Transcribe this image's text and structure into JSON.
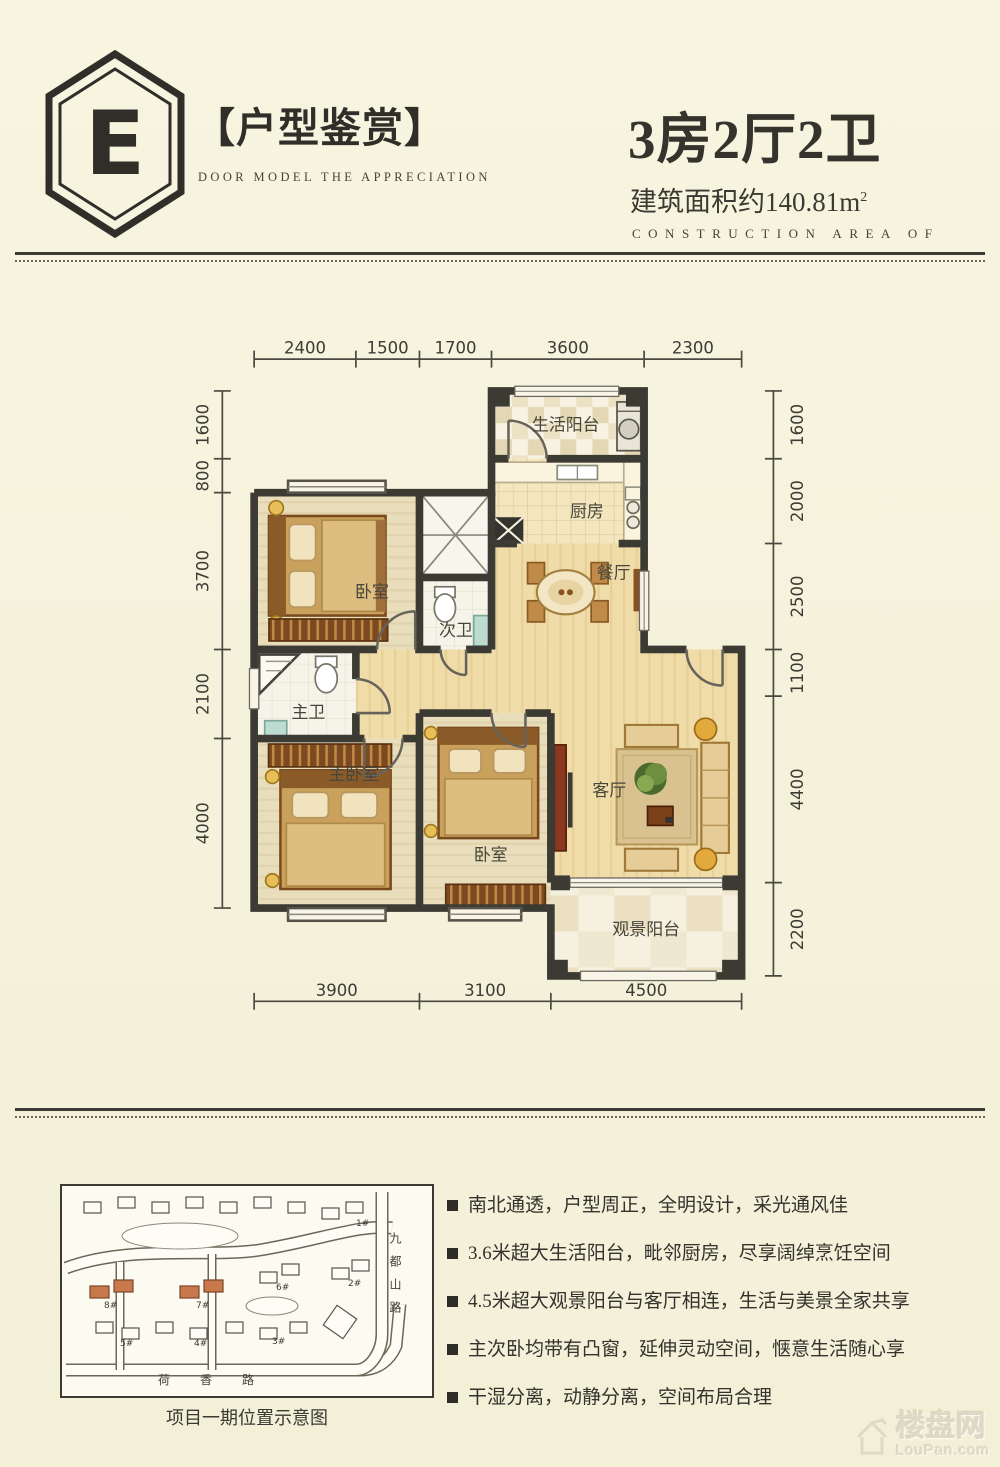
{
  "header": {
    "logo_letter": "E",
    "title": "【户型鉴赏】",
    "subtitle": "DOOR MODEL THE APPRECIATION",
    "unit_type": "3房2厅2卫",
    "area_label": "建筑面积约140.81m",
    "area_sup": "2",
    "area_en": "CONSTRUCTION AREA OF"
  },
  "plan": {
    "dims_top": [
      "2400",
      "1500",
      "1700",
      "3600",
      "2300"
    ],
    "dims_left": [
      "1600",
      "800",
      "3700",
      "2100",
      "4000"
    ],
    "dims_right": [
      "1600",
      "2000",
      "2500",
      "1100",
      "4400",
      "2200"
    ],
    "dims_bottom": [
      "3900",
      "3100",
      "4500"
    ],
    "rooms": {
      "life_balcony": "生活阳台",
      "kitchen": "厨房",
      "second_bath": "次卫",
      "dining": "餐厅",
      "bedroom_top": "卧室",
      "master_bath": "主卫",
      "master_bedroom": "主卧室",
      "bedroom_bottom": "卧室",
      "living_room": "客厅",
      "view_balcony": "观景阳台"
    }
  },
  "sitemap": {
    "caption": "项目一期位置示意图",
    "road_right": "九都山路",
    "road_bottom": "荷香路",
    "buildings": [
      {
        "label": "1#"
      },
      {
        "label": "2#"
      },
      {
        "label": "3#"
      },
      {
        "label": "4#"
      },
      {
        "label": "5#"
      },
      {
        "label": "6#"
      },
      {
        "label": "7#"
      },
      {
        "label": "8#"
      }
    ],
    "highlight_color": "#c8784a"
  },
  "features": {
    "items": [
      "南北通透，户型周正，全明设计，采光通风佳",
      "3.6米超大生活阳台，毗邻厨房，尽享阔绰烹饪空间",
      "4.5米超大观景阳台与客厅相连，生活与美景全家共享",
      "主次卧均带有凸窗，延伸灵动空间，惬意生活随心享",
      "干湿分离，动静分离，空间布局合理"
    ]
  },
  "watermark": {
    "cn": "楼盘网",
    "en": "LouPan.com"
  },
  "colors": {
    "background": "#f5f2dc",
    "ink": "#33322c",
    "wall": "#3b3a33",
    "wood_floor": "#e9debc",
    "warm_floor": "#efdca8",
    "highlight": "#c8784a"
  }
}
